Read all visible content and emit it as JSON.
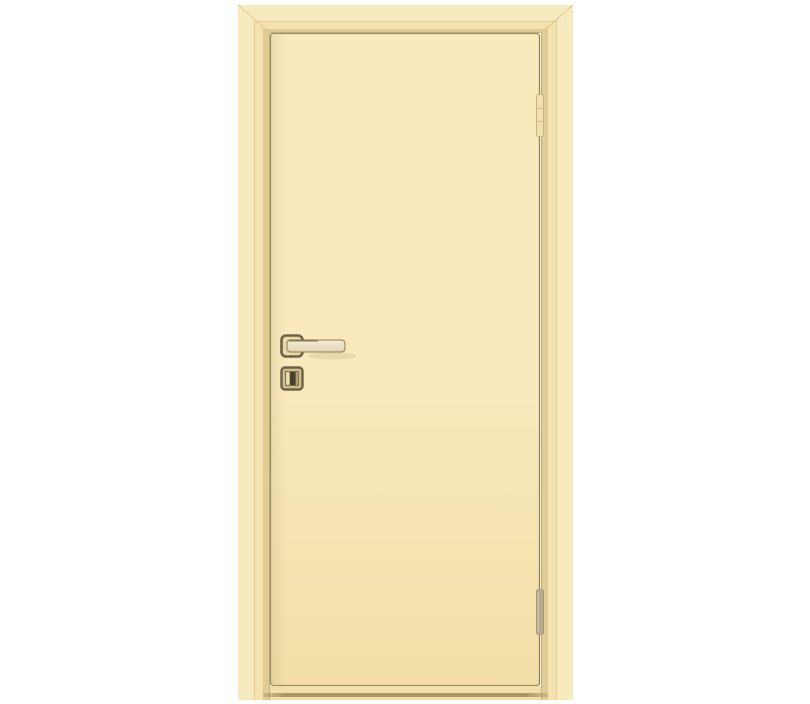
{
  "subject": {
    "description": "Product photo of a single flush interior door, beige/ivory painted, shown closed in its frame",
    "door_swing": "right-hinged",
    "visible_hardware": [
      "lever-handle",
      "wc-turn-escutcheon",
      "top-hinge",
      "bottom-hinge"
    ]
  },
  "elements": [
    {
      "name": "door-casing-frame",
      "label": "beige door frame with mitered top corners"
    },
    {
      "name": "door-leaf",
      "label": "flat flush door leaf, ivory painted"
    },
    {
      "name": "lever-handle",
      "label": "square-rosette lever handle pointing right"
    },
    {
      "name": "wc-escutcheon",
      "label": "square escutcheon with dark vertical turn slot"
    },
    {
      "name": "top-hinge",
      "label": "concealed-style hinge, upper right"
    },
    {
      "name": "bottom-hinge",
      "label": "concealed-style hinge, lower right"
    },
    {
      "name": "threshold-line",
      "label": "dark threshold shadow line at floor"
    }
  ],
  "colors": {
    "background": "#ffffff",
    "casing_base": "#f5e3af",
    "casing_highlight": "#faefc9",
    "casing_groove": "#d9c28b",
    "reveal_shadow": "#d9c48d",
    "reveal_line": "#a4925f",
    "leaf_top": "#f9e9bc",
    "leaf_bottom": "#f2dea6",
    "leaf_outline": "#9b8b5e",
    "gap_line": "#8f7f52",
    "under_leaf": "#f2dfa7",
    "threshold": "#9f8e5d",
    "handle_metal_dark": "#6f6246",
    "handle_metal_mid": "#8a7c58",
    "handle_face": "#f4ecd6",
    "handle_face_shade": "#e3d6b0",
    "handle_shadow": "#d8c89b",
    "rosette_fill": "#ead9a6",
    "escutcheon_fill": "#cfc08e",
    "escutcheon_inner": "#b3a271",
    "escutcheon_slot": "#46402e",
    "escutcheon_sliver": "#eadfb0",
    "hinge_top_fill": "#f0e0ae",
    "hinge_top_edge": "#c9b37c",
    "hinge_bottom_fill": "#b9ac8e",
    "hinge_bottom_edge": "#99906f",
    "hinge_bottom_highlight": "#d8cdb0"
  }
}
